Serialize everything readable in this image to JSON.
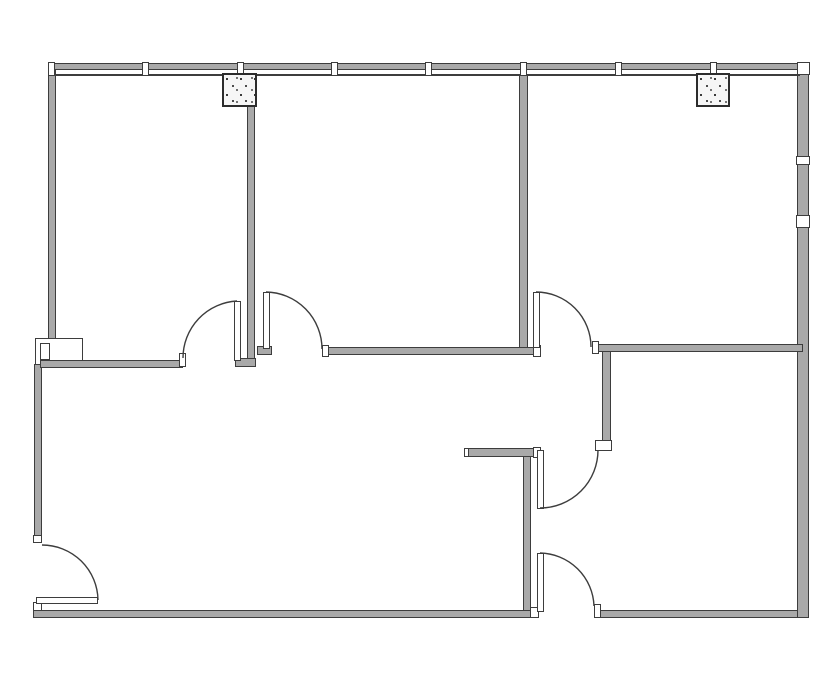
{
  "meta": {
    "title": "Office suite floor plan",
    "canvas_width": 835,
    "canvas_height": 678
  },
  "style": {
    "background": "#ffffff",
    "line_color": "#3d3d3d",
    "wall_fill": "#a9a9a9",
    "column_dot_color": "#1d1d1d"
  },
  "plan": {
    "boxes": [
      {
        "name": "wall-box-left",
        "x": 35,
        "y": 338,
        "w": 48,
        "h": 27
      },
      {
        "name": "wall-box-left-inner",
        "x": 40,
        "y": 343,
        "w": 10,
        "h": 17
      }
    ],
    "walls": [
      {
        "name": "top-exterior-window-wall",
        "x": 48,
        "y": 63,
        "w": 760,
        "h": 7
      },
      {
        "name": "left-exterior-wall-upper",
        "x": 48,
        "y": 69,
        "w": 8,
        "h": 270
      },
      {
        "name": "left-exterior-wall-lower",
        "x": 34,
        "y": 364,
        "w": 8,
        "h": 179
      },
      {
        "name": "bottom-exterior-wall-left",
        "x": 33,
        "y": 610,
        "w": 505,
        "h": 8
      },
      {
        "name": "bottom-exterior-wall-right",
        "x": 594,
        "y": 610,
        "w": 215,
        "h": 8
      },
      {
        "name": "right-exterior-wall-upper",
        "x": 797,
        "y": 69,
        "w": 12,
        "h": 148
      },
      {
        "name": "right-exterior-wall-lower",
        "x": 797,
        "y": 227,
        "w": 12,
        "h": 391
      },
      {
        "name": "room1-bottom-wall",
        "x": 40,
        "y": 360,
        "w": 143,
        "h": 8
      },
      {
        "name": "partition-wall-room1-room2",
        "x": 247,
        "y": 105,
        "w": 8,
        "h": 256
      },
      {
        "name": "partition-wall-1-foot",
        "x": 235,
        "y": 358,
        "w": 21,
        "h": 9
      },
      {
        "name": "door2-hinge-jamb",
        "x": 257,
        "y": 346,
        "w": 15,
        "h": 9
      },
      {
        "name": "room2-bottom-wall",
        "x": 322,
        "y": 347,
        "w": 219,
        "h": 8
      },
      {
        "name": "partition-wall-room2-room3",
        "x": 519,
        "y": 74,
        "w": 9,
        "h": 274
      },
      {
        "name": "room3-bottom-wall",
        "x": 592,
        "y": 344,
        "w": 211,
        "h": 8
      },
      {
        "name": "entry-wall-vertical",
        "x": 602,
        "y": 351,
        "w": 9,
        "h": 90
      },
      {
        "name": "alcove-partition-wall",
        "x": 464,
        "y": 448,
        "w": 76,
        "h": 9
      },
      {
        "name": "core-wall-vertical",
        "x": 523,
        "y": 456,
        "w": 8,
        "h": 155
      }
    ],
    "lines": [
      {
        "name": "top-wall-inner-face",
        "x": 52,
        "y": 74,
        "w": 748,
        "h": 2
      }
    ],
    "white_boxes": [
      {
        "name": "top-right-corner-post",
        "x": 797,
        "y": 62,
        "w": 13,
        "h": 13
      },
      {
        "name": "right-wall-window-mullion",
        "x": 796,
        "y": 156,
        "w": 14,
        "h": 9
      },
      {
        "name": "right-wall-break-post",
        "x": 796,
        "y": 215,
        "w": 14,
        "h": 13
      },
      {
        "name": "entry-door-jamb-box",
        "x": 595,
        "y": 440,
        "w": 17,
        "h": 11
      }
    ],
    "caps": [
      {
        "name": "door1-left-jamb-cap",
        "x": 179,
        "y": 353,
        "w": 7,
        "h": 14
      },
      {
        "name": "room2-wall-left-cap",
        "x": 322,
        "y": 345,
        "w": 7,
        "h": 12
      },
      {
        "name": "room2-wall-right-cap",
        "x": 533,
        "y": 345,
        "w": 8,
        "h": 12
      },
      {
        "name": "room3-wall-left-cap",
        "x": 592,
        "y": 341,
        "w": 7,
        "h": 13
      },
      {
        "name": "left-wall-bottom-cap",
        "x": 33,
        "y": 535,
        "w": 9,
        "h": 8
      },
      {
        "name": "bottom-left-corner-cap",
        "x": 33,
        "y": 602,
        "w": 9,
        "h": 9
      },
      {
        "name": "bottom-wall-left-end-cap",
        "x": 530,
        "y": 607,
        "w": 9,
        "h": 11
      },
      {
        "name": "bottom-wall-right-end-cap",
        "x": 594,
        "y": 604,
        "w": 7,
        "h": 14
      },
      {
        "name": "alcove-wall-left-cap",
        "x": 464,
        "y": 448,
        "w": 5,
        "h": 9
      },
      {
        "name": "alcove-wall-right-cap",
        "x": 533,
        "y": 447,
        "w": 8,
        "h": 11
      }
    ],
    "mullions": [
      {
        "name": "window-mullion-1",
        "x": 48,
        "y": 62,
        "w": 7,
        "h": 14
      },
      {
        "name": "window-mullion-2",
        "x": 142,
        "y": 62,
        "w": 7,
        "h": 14
      },
      {
        "name": "window-mullion-3",
        "x": 237,
        "y": 62,
        "w": 7,
        "h": 14
      },
      {
        "name": "window-mullion-4",
        "x": 331,
        "y": 62,
        "w": 7,
        "h": 14
      },
      {
        "name": "window-mullion-5",
        "x": 425,
        "y": 62,
        "w": 7,
        "h": 14
      },
      {
        "name": "window-mullion-6",
        "x": 520,
        "y": 62,
        "w": 7,
        "h": 14
      },
      {
        "name": "window-mullion-7",
        "x": 615,
        "y": 62,
        "w": 7,
        "h": 14
      },
      {
        "name": "window-mullion-8",
        "x": 710,
        "y": 62,
        "w": 7,
        "h": 14
      }
    ],
    "columns": [
      {
        "name": "structural-column-left",
        "x": 222,
        "y": 73,
        "w": 35,
        "h": 34
      },
      {
        "name": "structural-column-right",
        "x": 696,
        "y": 73,
        "w": 34,
        "h": 34
      }
    ],
    "leaves": [
      {
        "name": "door1-leaf",
        "x": 234,
        "y": 301,
        "w": 7,
        "h": 60
      },
      {
        "name": "door2-leaf",
        "x": 263,
        "y": 292,
        "w": 7,
        "h": 57
      },
      {
        "name": "door3-leaf",
        "x": 533,
        "y": 292,
        "w": 7,
        "h": 56
      },
      {
        "name": "door4-leaf",
        "x": 537,
        "y": 450,
        "w": 7,
        "h": 59
      },
      {
        "name": "door5-leaf",
        "x": 537,
        "y": 553,
        "w": 7,
        "h": 59
      },
      {
        "name": "door6-leaf",
        "x": 36,
        "y": 597,
        "w": 62,
        "h": 7
      }
    ],
    "arcs": [
      {
        "name": "door1-swing-arc",
        "d": "M183 358 A57 57 0 0 1 237 301"
      },
      {
        "name": "door2-swing-arc",
        "d": "M266 292 A57 57 0 0 1 322 349"
      },
      {
        "name": "door3-swing-arc",
        "d": "M536 292 A55 55 0 0 1 591 347"
      },
      {
        "name": "door4-swing-arc",
        "d": "M540 508 A58 58 0 0 0 598 450"
      },
      {
        "name": "door5-swing-arc",
        "d": "M540 553 A55 55 0 0 1 594 606"
      },
      {
        "name": "door6-swing-arc",
        "d": "M98 600 A56 56 0 0 0 42 545"
      }
    ]
  }
}
